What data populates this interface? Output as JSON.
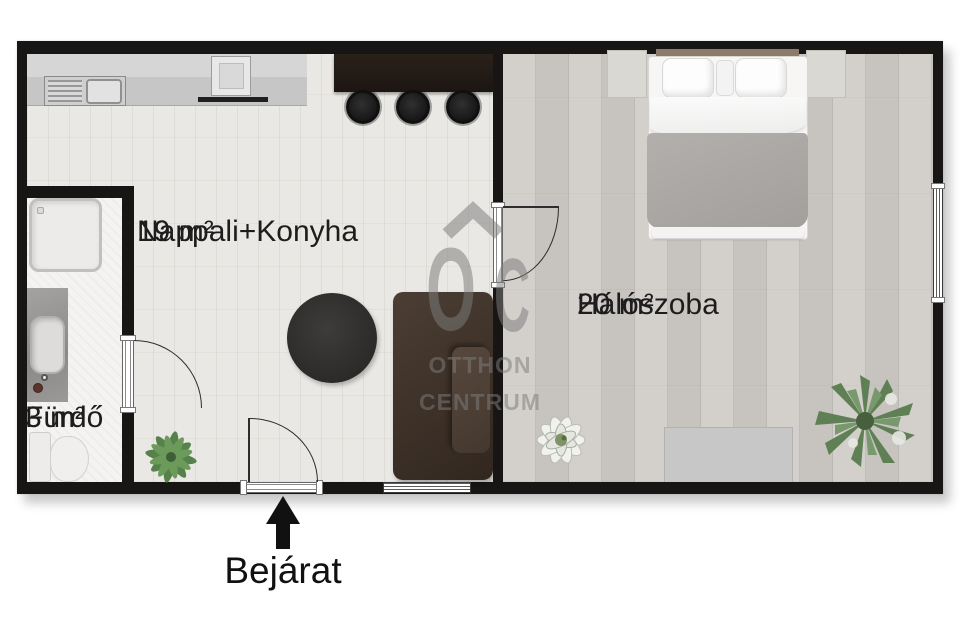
{
  "rooms": {
    "living": {
      "name": "Nappali+Konyha",
      "area": "19 m²"
    },
    "bedroom": {
      "name": "Hálószoba",
      "area": "20 m²"
    },
    "bathroom": {
      "name": "Fürdő",
      "area": "3 m²"
    }
  },
  "entrance": {
    "label": "Bejárat"
  },
  "watermark": {
    "monogram_o": "O",
    "monogram_c": "C",
    "line1": "OTTHON",
    "line2": "CENTRUM"
  },
  "colors": {
    "wall": "#171614",
    "living_floor": "#eae8e4",
    "bedroom_floor": "#cbc7c2",
    "bathroom_floor": "#f4f3f1",
    "bar_counter": "#1c1511",
    "sofa": "#3d3128",
    "rug": "#2b2a29",
    "blanket": "#a9a6a3",
    "bed_linen": "#f7f6f5",
    "plant_green": "#5d8050",
    "watermark_gray": "#7d7d7d",
    "text": "#1d1d1d"
  }
}
